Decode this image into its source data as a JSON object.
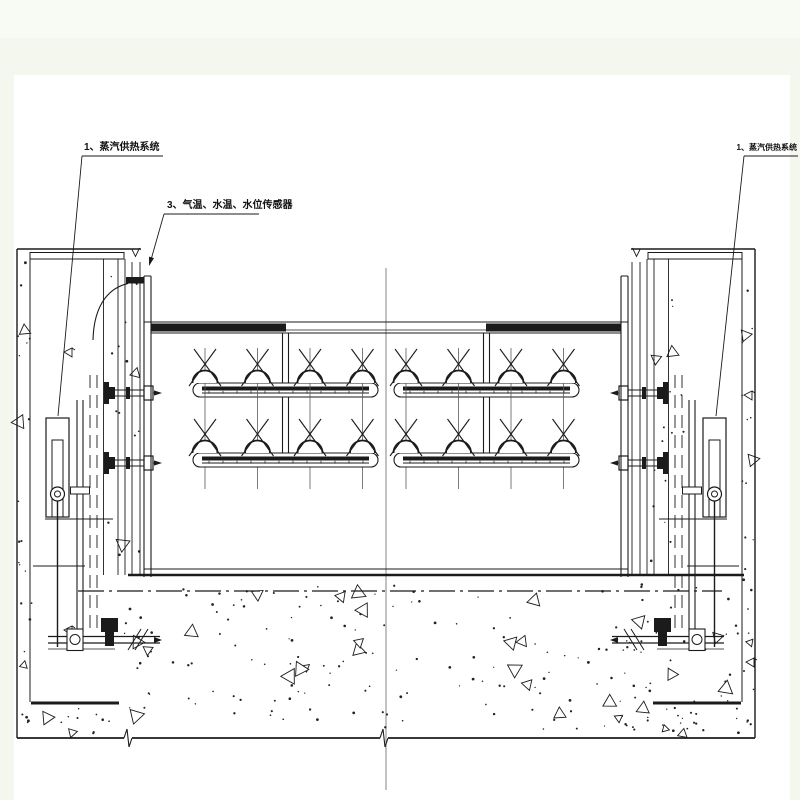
{
  "drawing": {
    "title_hint": "gate steam heating system cross-section",
    "colors": {
      "paper": "#ffffff",
      "margin": "#f4f7ee",
      "margin_top": "#f8faf4",
      "line": "#1b1b1b",
      "thin_line": "#6f6f6f"
    },
    "labels": {
      "left_system": "1、蒸汽供热系统",
      "sensors": "3、气温、水温、水位传感器",
      "right_system": "1、蒸汽供热系统"
    }
  }
}
